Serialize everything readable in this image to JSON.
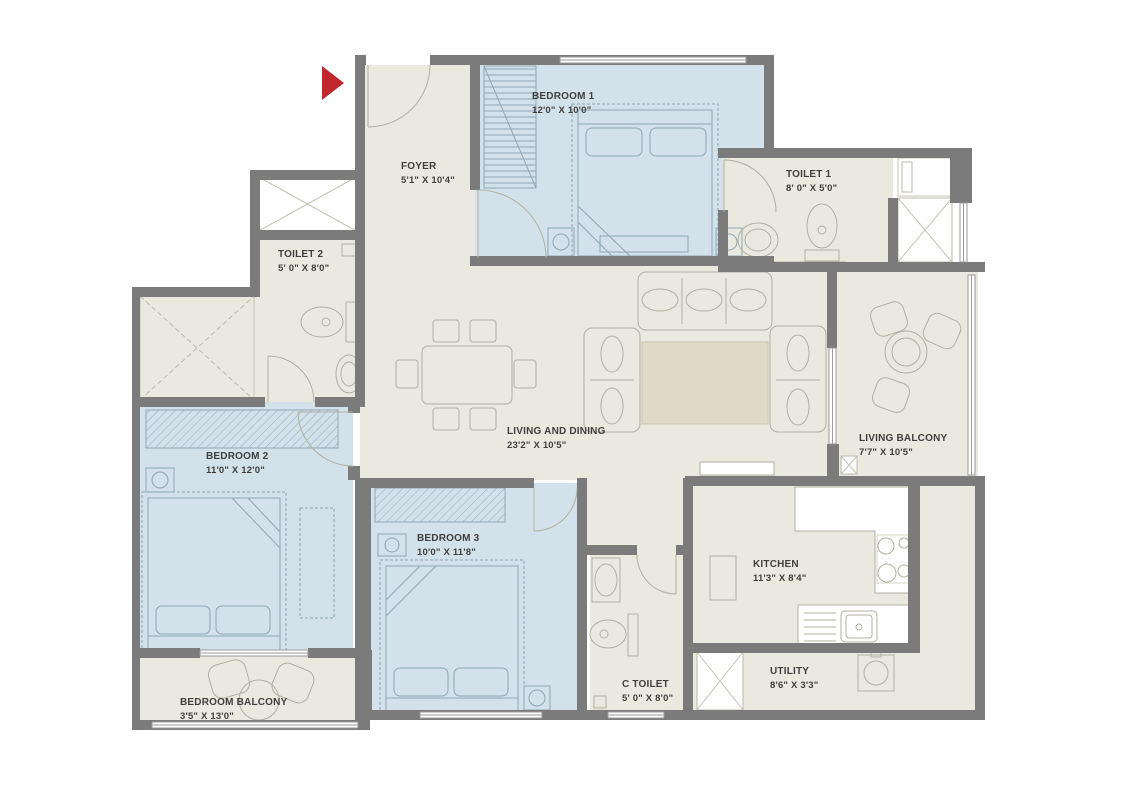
{
  "plan_title": "3 BHK Apartment Floor Plan",
  "colors": {
    "wall": "#7b7b7b",
    "room_beige": "#eae9df",
    "room_blue": "#d2e1ea",
    "rug": "#e0dbc6",
    "entry_arrow": "#c1272d",
    "label_text": "#3f3f3f"
  },
  "icons": {
    "entry_marker": "entry-arrow-icon"
  },
  "rooms": [
    {
      "id": "bedroom-1",
      "name": "BEDROOM 1",
      "dims": "12'0\" X 10'0\""
    },
    {
      "id": "foyer",
      "name": "FOYER",
      "dims": "5'1\" X 10'4\""
    },
    {
      "id": "toilet-1",
      "name": "TOILET 1",
      "dims": "8' 0\" X 5'0\""
    },
    {
      "id": "toilet-2",
      "name": "TOILET 2",
      "dims": "5' 0\" X 8'0\""
    },
    {
      "id": "bedroom-2",
      "name": "BEDROOM 2",
      "dims": "11'0\" X 12'0\""
    },
    {
      "id": "living-dining",
      "name": "LIVING  AND DINING",
      "dims": "23'2\" X 10'5\""
    },
    {
      "id": "living-balcony",
      "name": "LIVING BALCONY",
      "dims": "7'7\" X 10'5\""
    },
    {
      "id": "bedroom-3",
      "name": "BEDROOM 3",
      "dims": "10'0\" X 11'8\""
    },
    {
      "id": "kitchen",
      "name": "KITCHEN",
      "dims": "11'3\" X 8'4\""
    },
    {
      "id": "c-toilet",
      "name": "C TOILET",
      "dims": "5' 0\" X 8'0\""
    },
    {
      "id": "utility",
      "name": "UTILITY",
      "dims": "8'6\" X 3'3\""
    },
    {
      "id": "bedroom-balcony",
      "name": "BEDROOM BALCONY",
      "dims": "3'5\" X 13'0\""
    }
  ]
}
